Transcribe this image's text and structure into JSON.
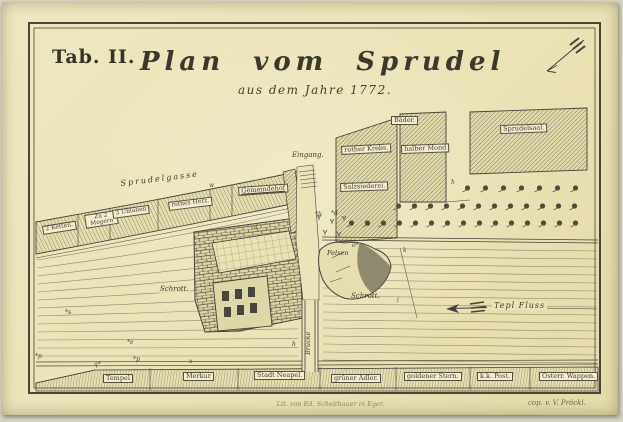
{
  "colors": {
    "paper": "#ebe2b6",
    "ink": "#45423a",
    "river_line": "#8d8770",
    "label_bg": "#f4edcf"
  },
  "header": {
    "tab_label": "Tab. II.",
    "title": "Plan vom Sprudel",
    "subtitle": "aus dem Jahre 1772."
  },
  "map": {
    "street": "Sprudelgasse",
    "entrance": "Eingang.",
    "river": "Tepl Fluss",
    "bridge": "Brücke",
    "rock": "Felsen",
    "debris_left": "Schrott.",
    "debris_right": "Schrott.",
    "north_row": [
      "2 Ketten.",
      "Zu 2 Mogern",
      "3 Uhlanen",
      "rothes Herz.",
      "Gemeindehof"
    ],
    "sprudel_block": [
      "rother Krebs.",
      "halber Mond",
      "Bäder.",
      "Sprudelsaal.",
      "Salzsiederei."
    ],
    "south_row": [
      "Tempel",
      "Merkur",
      "Stadt Neapel.",
      "grüner Adler.",
      "goldener Stern.",
      "k.k. Post.",
      "Österr. Wappen."
    ],
    "marks": [
      "h",
      "h",
      "k",
      "i",
      "a",
      "w",
      "o*",
      "*s",
      "*e",
      "*p",
      "q*",
      "*p",
      "x",
      "*b",
      "*d"
    ]
  },
  "credits": {
    "lithographer": "Lit. von Ed. Scheithauer in Eger.",
    "copyist": "cop. v. V. Pröckl."
  }
}
